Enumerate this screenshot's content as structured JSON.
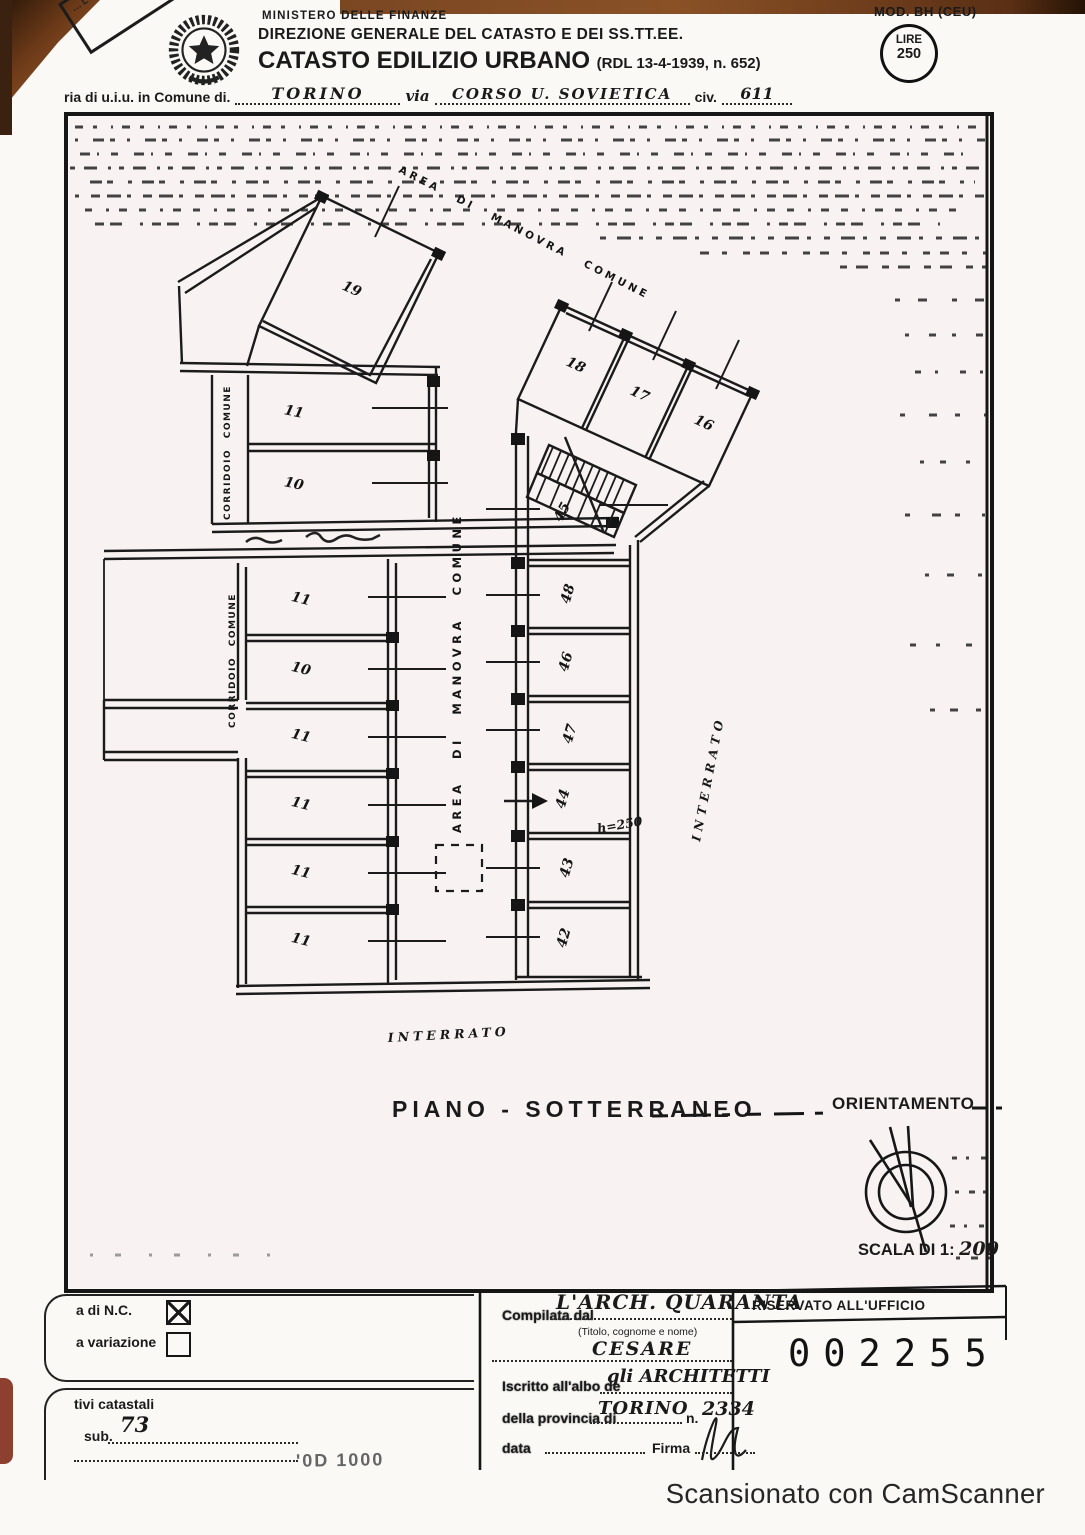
{
  "scan": {
    "watermark": "Scansionato con CamScanner"
  },
  "header": {
    "corner_stamp": "…LLARIO",
    "ministry": "MINISTERO DELLE FINANZE",
    "direzione": "DIREZIONE GENERALE DEL CATASTO E DEI SS.TT.EE.",
    "title": "CATASTO EDILIZIO URBANO",
    "title_ref": "(RDL 13-4-1939, n. 652)",
    "mod_label": "MOD. BH (CEU)",
    "lire_label": "LIRE",
    "lire_value": "250"
  },
  "address": {
    "prefix": "ria di u.i.u. in Comune di.",
    "comune": "TORINO",
    "via_label": "via",
    "via_value": "CORSO  U.  SOVIETICA",
    "civ_label": "civ.",
    "civ_value": "611"
  },
  "plan": {
    "area_manovra_diagonal": "AREA DI MANOVRA COMUNE",
    "area_manovra_vertical": "AREA DI MANOVRA COMUNE",
    "corridoio_upper": "CORRIDOIO COMUNE",
    "corridoio_lower": "CORRIDOIO COMUNE",
    "interrato_side": "INTERRATO",
    "interrato_bottom": "INTERRATO",
    "box19": "19",
    "cluster": [
      "18",
      "17",
      "16"
    ],
    "upper_left_stalls": [
      "11",
      "10"
    ],
    "lower_left_stalls": [
      "11",
      "10",
      "11",
      "11",
      "11",
      "11"
    ],
    "right_stalls": [
      "45",
      "48",
      "46",
      "47",
      "44",
      "43",
      "42"
    ],
    "height_note": "h=250",
    "caption": "PIANO  -  SOTTERRANEO",
    "orientamento": "ORIENTAMENTO",
    "scala_label": "SCALA DI 1:",
    "scala_value": "200"
  },
  "form": {
    "nc_label": "a di N.C.",
    "nc_checked": true,
    "variazione_label": "a variazione",
    "variazione_checked": false,
    "catastali_label": "tivi catastali",
    "sub_label": "sub.",
    "sub_value": "73",
    "compilata_label": "Compilata dal",
    "name_value": "L'ARCH. QUARANTA",
    "name_hint": "(Titolo, cognome e nome)",
    "name_value2": "CESARE",
    "albo_label": "Iscritto all'albo de",
    "albo_value": "gli ARCHITETTI",
    "provincia_label": "della provincia di",
    "provincia_value": "TORINO",
    "num_label": "n.",
    "num_value": "2334",
    "data_label": "data",
    "firma_label": "Firma",
    "print_code": "'0D 1000",
    "ufficio_header": "RISERVATO ALL'UFFICIO",
    "ufficio_number": "002255"
  }
}
